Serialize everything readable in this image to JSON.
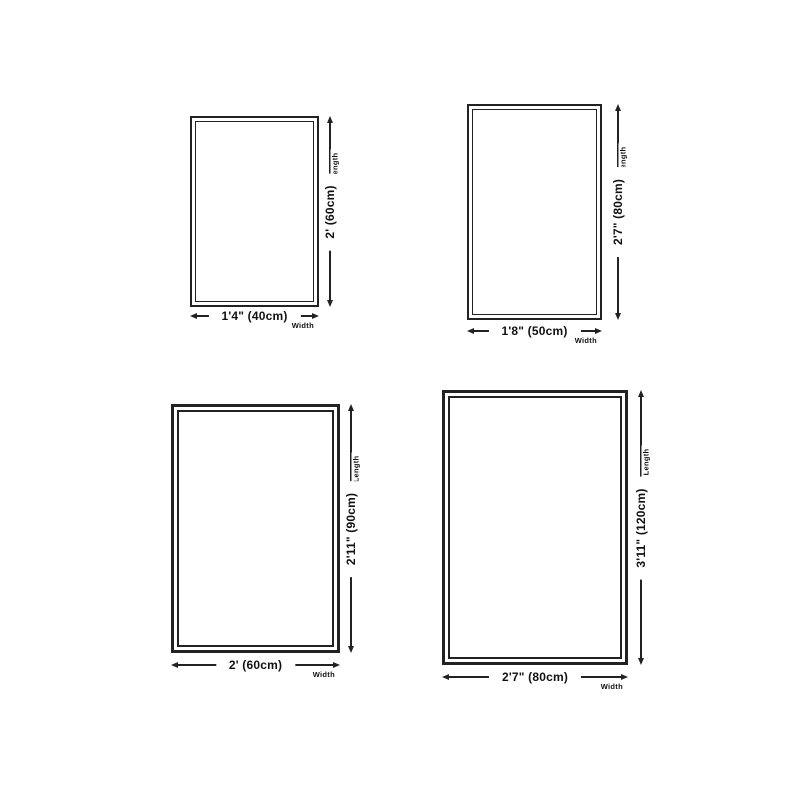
{
  "colors": {
    "line": "#222222",
    "text": "#111111",
    "background": "#ffffff"
  },
  "diagrams": [
    {
      "name": "rug-size-40x60cm",
      "width_label": "1'4\" (40cm)",
      "length_label": "2' (60cm)",
      "width_axis_label": "Width",
      "length_axis_label": "Length"
    },
    {
      "name": "rug-size-50x80cm",
      "width_label": "1'8\" (50cm)",
      "length_label": "2'7\" (80cm)",
      "width_axis_label": "Width",
      "length_axis_label": "Length"
    },
    {
      "name": "rug-size-60x90cm",
      "width_label": "2' (60cm)",
      "length_label": "2'11\" (90cm)",
      "width_axis_label": "Width",
      "length_axis_label": "Length"
    },
    {
      "name": "rug-size-80x120cm",
      "width_label": "2'7\" (80cm)",
      "length_label": "3'11\" (120cm)",
      "width_axis_label": "Width",
      "length_axis_label": "Length"
    }
  ]
}
